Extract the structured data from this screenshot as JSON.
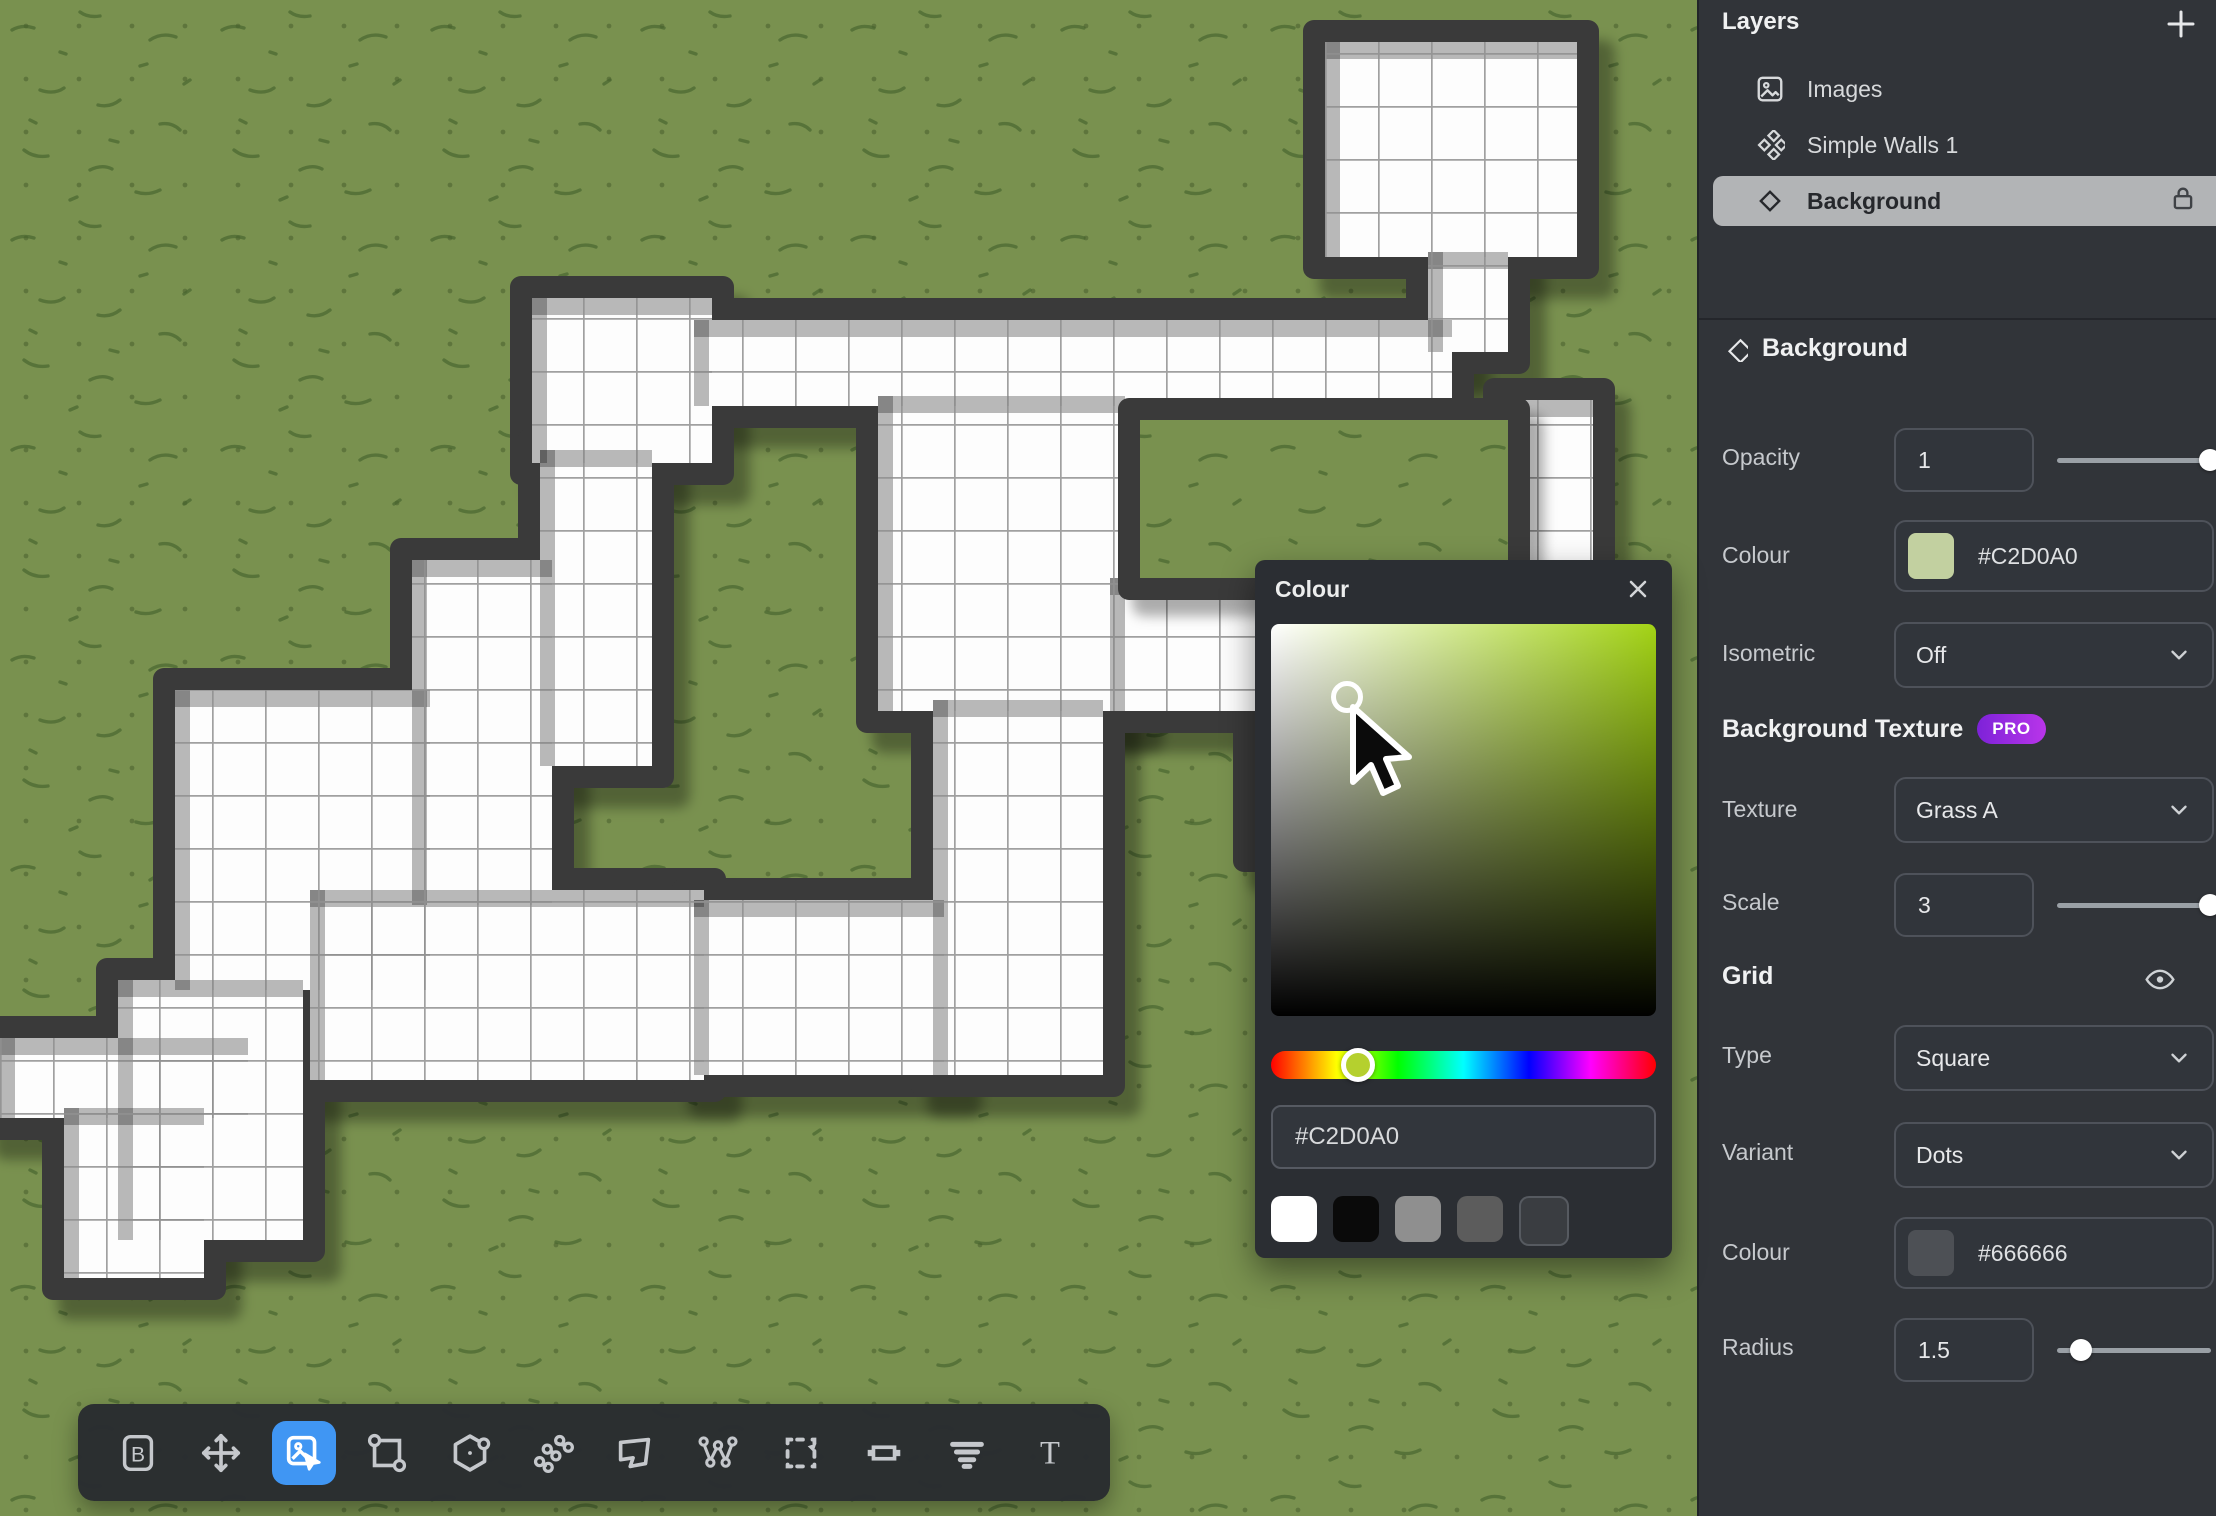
{
  "layers_panel": {
    "title": "Layers",
    "add_icon": "plus-icon",
    "items": [
      {
        "label": "Images",
        "icon": "image-icon",
        "selected": false,
        "locked": false
      },
      {
        "label": "Simple Walls 1",
        "icon": "walls-icon",
        "selected": false,
        "locked": false
      },
      {
        "label": "Background",
        "icon": "diamond-icon",
        "selected": true,
        "locked": true
      }
    ]
  },
  "properties_panel": {
    "section_title": "Background",
    "section_icon": "diamond-icon",
    "opacity": {
      "label": "Opacity",
      "value": "1",
      "slider_pct": 97
    },
    "colour": {
      "label": "Colour",
      "value": "#C2D0A0",
      "swatch": "#C2D0A0"
    },
    "isometric": {
      "label": "Isometric",
      "value": "Off"
    },
    "texture_section": {
      "title": "Background Texture",
      "badge": "PRO"
    },
    "texture": {
      "label": "Texture",
      "value": "Grass A"
    },
    "scale": {
      "label": "Scale",
      "value": "3",
      "slider_pct": 97
    },
    "grid_section": {
      "title": "Grid",
      "eye_icon": "eye-icon"
    },
    "type": {
      "label": "Type",
      "value": "Square"
    },
    "variant": {
      "label": "Variant",
      "value": "Dots"
    },
    "grid_colour": {
      "label": "Colour",
      "value": "#666666",
      "swatch": "#4d5055"
    },
    "radius": {
      "label": "Radius",
      "value": "1.5",
      "slider_pct": 15
    }
  },
  "colour_dialog": {
    "title": "Colour",
    "close_icon": "close-icon",
    "hex_value": "#C2D0A0",
    "hue_pct": 22.6,
    "sv_handle": {
      "x_px": 94,
      "y_px": 74
    },
    "swatches": [
      {
        "color": "#ffffff",
        "border": "none"
      },
      {
        "color": "#0a0a0a",
        "border": "none"
      },
      {
        "color": "#8f8f8f",
        "border": "none"
      },
      {
        "color": "#5c5c5c",
        "border": "none"
      },
      {
        "color": "#3a3d41",
        "border": "#565a60"
      }
    ]
  },
  "toolbar": {
    "active_tool": "image-select",
    "tools": [
      {
        "id": "boxed-b",
        "icon": "boxed-b-icon"
      },
      {
        "id": "move",
        "icon": "move-icon"
      },
      {
        "id": "image-select",
        "icon": "image-cursor-icon"
      },
      {
        "id": "rect-transform",
        "icon": "rect-nodes-icon"
      },
      {
        "id": "hexagon",
        "icon": "hexagon-node-icon"
      },
      {
        "id": "wall-scatter",
        "icon": "wall-scatter-icon"
      },
      {
        "id": "polygon",
        "icon": "polygon-icon"
      },
      {
        "id": "path-nodes",
        "icon": "path-nodes-icon"
      },
      {
        "id": "marquee-select",
        "icon": "marquee-icon"
      },
      {
        "id": "door",
        "icon": "door-icon"
      },
      {
        "id": "stairs",
        "icon": "stairs-icon"
      },
      {
        "id": "text",
        "icon": "text-icon",
        "glyph": "T"
      }
    ]
  },
  "canvas": {
    "map": {
      "unit": 53,
      "wall_thickness": 22,
      "colors": {
        "grass": "#79914f",
        "speckle": "#44622c",
        "wall": "#3a3a3a",
        "floor": "#fdfdfd",
        "grid_line": "#8f8f8f",
        "shadow": "rgba(10,16,4,0.32)",
        "inner_shade": "rgba(0,0,0,0.27)"
      },
      "rooms": [
        [
          1325,
          42,
          252,
          215
        ],
        [
          1428,
          252,
          80,
          100
        ],
        [
          532,
          298,
          180,
          165
        ],
        [
          694,
          320,
          758,
          86
        ],
        [
          878,
          396,
          247,
          315
        ],
        [
          1110,
          578,
          483,
          133
        ],
        [
          1505,
          400,
          88,
          311
        ],
        [
          540,
          450,
          112,
          316
        ],
        [
          412,
          560,
          140,
          345
        ],
        [
          175,
          690,
          255,
          300
        ],
        [
          0,
          1038,
          248,
          80
        ],
        [
          118,
          980,
          185,
          260
        ],
        [
          310,
          890,
          394,
          190
        ],
        [
          694,
          900,
          250,
          175
        ],
        [
          933,
          700,
          170,
          375
        ],
        [
          1255,
          690,
          200,
          160
        ],
        [
          64,
          1108,
          140,
          170
        ]
      ],
      "courtyard": [
        1140,
        420,
        368,
        158
      ]
    }
  }
}
